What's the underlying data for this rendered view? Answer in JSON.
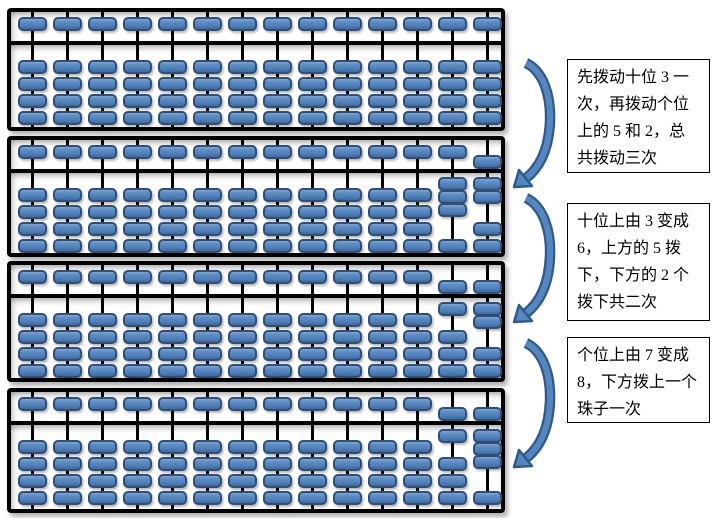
{
  "colors": {
    "bead_fill": "#4f81bd",
    "bead_highlight": "#7fa5d2",
    "bead_shade": "#41699b",
    "bead_border": "#2f4f75",
    "frame": "#000000",
    "arrow_fill": "#5586bf",
    "arrow_outline": "#2e5a8c",
    "note_border": "#000000",
    "note_text": "#000000",
    "background": "#ffffff"
  },
  "abacus": {
    "columns": 14,
    "heaven_beads_per_rod": 1,
    "earth_beads_per_rod": 4,
    "default_column": {
      "heaven": "up",
      "earth_up": 0
    },
    "panels": [
      {
        "name": "state-initial",
        "value": 0,
        "overrides": {}
      },
      {
        "name": "state-after-step-1",
        "value": 37,
        "overrides": {
          "12": {
            "heaven": "up",
            "earth_up": 3
          },
          "13": {
            "heaven": "down",
            "earth_up": 2
          }
        }
      },
      {
        "name": "state-after-step-2",
        "value": 67,
        "overrides": {
          "12": {
            "heaven": "down",
            "earth_up": 1
          },
          "13": {
            "heaven": "down",
            "earth_up": 2
          }
        }
      },
      {
        "name": "state-after-step-3",
        "value": 68,
        "overrides": {
          "12": {
            "heaven": "down",
            "earth_up": 1
          },
          "13": {
            "heaven": "down",
            "earth_up": 3
          }
        }
      }
    ]
  },
  "annotations": [
    {
      "text": "先拨动十位 3 一\n次，再拨动个位\n上的 5 和 2，总\n共拨动三次"
    },
    {
      "text": "十位上由 3 变成\n6，上方的 5 拨\n下，下方的 2 个\n拨下共二次"
    },
    {
      "text": "个位上由 7 变成\n8，下方拨上一个\n珠子一次"
    }
  ],
  "arrows": [
    {
      "name": "curved-arrow-1",
      "direction": "down"
    },
    {
      "name": "curved-arrow-2",
      "direction": "down"
    },
    {
      "name": "curved-arrow-3",
      "direction": "down"
    }
  ]
}
